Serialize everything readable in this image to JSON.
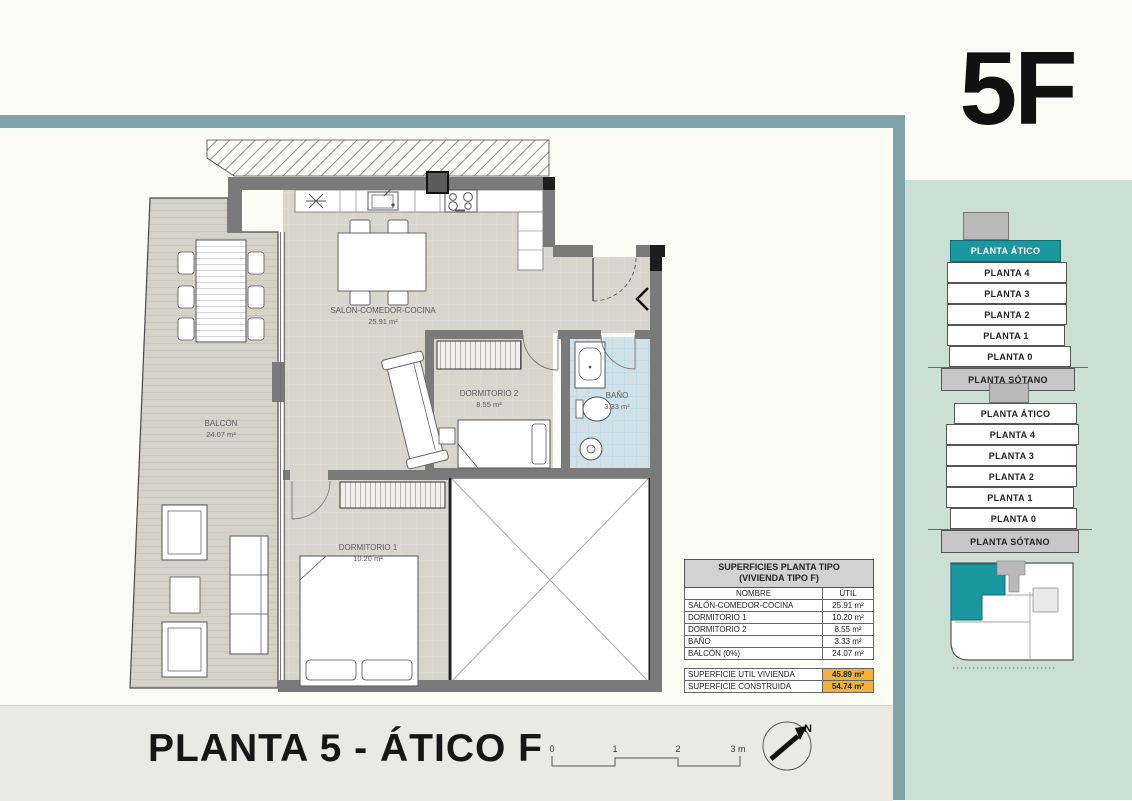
{
  "meta": {
    "unit_code": "5F",
    "sheet_title": "PLANTA 5 - ÁTICO F"
  },
  "plan": {
    "rooms": {
      "salon": {
        "name": "SALÓN-COMEDOR-COCINA",
        "area": "25.91 m²"
      },
      "dormitorio1": {
        "name": "DORMITORIO 1",
        "area": "10.20 m²"
      },
      "dormitorio2": {
        "name": "DORMITORIO 2",
        "area": "8.55 m²"
      },
      "bano": {
        "name": "BAÑO",
        "area": "3.33 m²"
      },
      "balcon": {
        "name": "BALCÓN",
        "area": "24.07 m²"
      }
    },
    "scale_bar": {
      "ticks": [
        "0",
        "1",
        "2",
        "3 m"
      ]
    },
    "compass_label": "N"
  },
  "surfaces_table": {
    "title_line1": "SUPERFICIES PLANTA TIPO",
    "title_line2": "(VIVIENDA TIPO F)",
    "col_name": "NOMBRE",
    "col_util": "ÚTIL",
    "rows": [
      {
        "name": "SALÓN-COMEDOR-COCINA",
        "util": "25.91 m²"
      },
      {
        "name": "DORMITORIO 1",
        "util": "10.20 m²"
      },
      {
        "name": "DORMITORIO 2",
        "util": "8.55 m²"
      },
      {
        "name": "BAÑO",
        "util": "3.33 m²"
      },
      {
        "name": "BALCÓN (0%)",
        "util": "24.07 m²"
      }
    ],
    "totals": [
      {
        "name": "SUPERFICIE UTIL VIVIENDA",
        "value": "45.89 m²"
      },
      {
        "name": "SUPERFICIE CONSTRUIDA",
        "value": "54.74 m²"
      }
    ]
  },
  "floor_stacks": [
    {
      "building": "edificio-1",
      "active_floor": "PLANTA ÁTICO",
      "floors": [
        "PLANTA ÁTICO",
        "PLANTA 4",
        "PLANTA 3",
        "PLANTA 2",
        "PLANTA 1",
        "PLANTA 0",
        "PLANTA SÓTANO"
      ]
    },
    {
      "building": "edificio-2",
      "active_floor": null,
      "floors": [
        "PLANTA ÁTICO",
        "PLANTA 4",
        "PLANTA 3",
        "PLANTA 2",
        "PLANTA 1",
        "PLANTA 0",
        "PLANTA SÓTANO"
      ]
    }
  ],
  "colors": {
    "frame_teal": "#7fa3aa",
    "sidebar_mint": "#cbdfd4",
    "active_teal": "#1b989f",
    "highlight_orange": "#f0b23a",
    "floor_beige": "#d8d5cc",
    "bath_blue": "#d0e1ea",
    "wall_gray": "#7a7a7a",
    "footer_gray": "#e9e9e6"
  }
}
